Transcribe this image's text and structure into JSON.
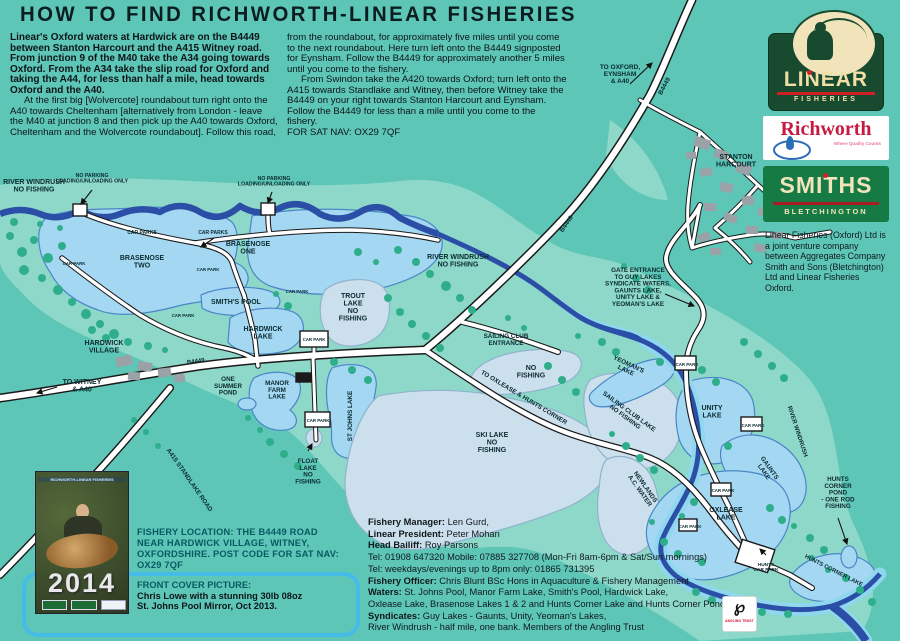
{
  "title": "HOW TO FIND RICHWORTH-LINEAR FISHERIES",
  "intro": {
    "col1_bold": "Linear's Oxford waters at Hardwick are on the B4449 between Stanton Harcourt and the A415 Witney road. From junction 9 of the M40 take the A34 going towards Oxford. From the A34 take the slip road for Oxford and taking the A44, for less than half a mile, head towards Oxford and the A40.",
    "col1_rest": "At the first big [Wolvercote] roundabout turn right onto the A40 towards Cheltenham [alternatively from London - leave the M40 at junction 8 and then pick up the A40 towards Oxford, Cheltenham and the Wolvercote roundabout]. Follow this road,",
    "col2_p1": "from the roundabout, for approximately five miles until you come to the next roundabout. Here turn left onto the B4449 signposted for Eynsham. Follow the B4449 for approximately another 5 miles until you come to the fishery.",
    "col2_p2": "From Swindon take the A420 towards Oxford; turn left onto the A415 towards Standlake and Witney, then before Witney take the B4449 on your right towards Stanton Harcourt and Eynsham. Follow the B4449 for less than a mile until you come to the fishery.",
    "col2_satnav": "FOR SAT NAV: OX29 7QF"
  },
  "logos": {
    "linear_name": "LINEAR",
    "linear_sub": "FISHERIES",
    "richworth_name": "Richworth",
    "richworth_tagline": "Where Quality Counts",
    "smiths_name": "SMITHS",
    "smiths_sub": "BLETCHINGTON",
    "joint_venture": "Linear Fisheries (Oxford) Ltd is a joint venture company between Aggregates Company Smith and Sons (Bletchington) Ltd and Linear Fisheries Oxford."
  },
  "location_box": {
    "location": "FISHERY LOCATION: THE B4449 ROAD NEAR HARDWICK VILLAGE, WITNEY, OXFORDSHIRE. POST CODE FOR SAT NAV: OX29 7QF",
    "front_cover_heading": "FRONT COVER PICTURE:",
    "front_cover_line1": "Chris Lowe with a stunning 30lb 08oz",
    "front_cover_line2": "St. Johns Pool Mirror, Oct 2013."
  },
  "cover": {
    "strip": "RICHWORTH-LINEAR FISHERIES",
    "year": "2014"
  },
  "angling": {
    "label": "ANGLING TRUST"
  },
  "contacts": {
    "lines": [
      {
        "label": "Fishery Manager:",
        "value": " Len Gurd,"
      },
      {
        "label": "Linear President:",
        "value": " Peter Mohan"
      },
      {
        "label": "Head Bailiff:",
        "value": " Roy Parsons"
      },
      {
        "label": "",
        "value": "Tel: 01908 647320 Mobile: 07885 327708 (Mon-Fri 8am-6pm & Sat/Sun mornings)"
      },
      {
        "label": "",
        "value": "Tel: weekdays/evenings up to 8pm only: 01865 731395"
      },
      {
        "label": "Fishery Officer:",
        "value": " Chris Blunt BSc Hons in Aquaculture & Fishery Management"
      },
      {
        "label": "Waters:",
        "value": " St. Johns Pool, Manor Farm Lake, Smith's Pool, Hardwick Lake,"
      },
      {
        "label": "",
        "value": "Oxlease Lake, Brasenose Lakes 1 & 2 and Hunts Corner Lake and Hunts Corner Pond."
      },
      {
        "label": "Syndicates:",
        "value": " Guy Lakes - Gaunts, Unity, Yeoman's Lakes,"
      },
      {
        "label": "",
        "value": "River Windrush - half mile, one bank. Members of the Angling Trust"
      }
    ]
  },
  "map_labels": [
    {
      "t": "RIVER WINDRUSH\nNO FISHING",
      "x": 34,
      "y": 184,
      "s": 7
    },
    {
      "t": "NO PARKING\nLOADING/UNLOADING ONLY",
      "x": 92,
      "y": 177,
      "s": 5.2
    },
    {
      "t": "NO PARKING\nLOADING/UNLOADING ONLY",
      "x": 274,
      "y": 180,
      "s": 5.2
    },
    {
      "t": "CAR PARKS",
      "x": 142,
      "y": 234,
      "s": 5
    },
    {
      "t": "CAR PARKS",
      "x": 213,
      "y": 234,
      "s": 5
    },
    {
      "t": "BRASENOSE\nTWO",
      "x": 142,
      "y": 260,
      "s": 7
    },
    {
      "t": "BRASENOSE\nONE",
      "x": 248,
      "y": 246,
      "s": 7
    },
    {
      "t": "RIVER WINDRUSH\nNO FISHING",
      "x": 458,
      "y": 259,
      "s": 7
    },
    {
      "t": "SMITH'S POOL",
      "x": 236,
      "y": 304,
      "s": 7
    },
    {
      "t": "HARDWICK\nLAKE",
      "x": 263,
      "y": 331,
      "s": 7
    },
    {
      "t": "TROUT\nLAKE\nNO\nFISHING",
      "x": 353,
      "y": 298,
      "s": 7
    },
    {
      "t": "HARDWICK\nVILLAGE",
      "x": 104,
      "y": 345,
      "s": 7
    },
    {
      "t": "TO WITNEY\n& A40",
      "x": 82,
      "y": 384,
      "s": 7
    },
    {
      "t": "B4449",
      "x": 196,
      "y": 363,
      "s": 6,
      "r": -8
    },
    {
      "t": "ONE\nSUMMER\nPOND",
      "x": 228,
      "y": 381,
      "s": 6.3
    },
    {
      "t": "MANOR\nFARM\nLAKE",
      "x": 277,
      "y": 385,
      "s": 6.3
    },
    {
      "t": "ST JOHNS LAKE",
      "x": 352,
      "y": 416,
      "s": 6.3,
      "r": -90
    },
    {
      "t": "FLOAT\nLAKE\nNO\nFISHING",
      "x": 308,
      "y": 463,
      "s": 6.3
    },
    {
      "t": "A415 STANDLAKE ROAD",
      "x": 188,
      "y": 481,
      "s": 6.3,
      "r": 55
    },
    {
      "t": "B4449",
      "x": 568,
      "y": 225,
      "s": 6.3,
      "r": -55
    },
    {
      "t": "B4449",
      "x": 666,
      "y": 87,
      "s": 6.3,
      "r": -62
    },
    {
      "t": "TO OXFORD,\nEYNSHAM\n& A40",
      "x": 620,
      "y": 69,
      "s": 6.5
    },
    {
      "t": "STANTON\nHARCOURT",
      "x": 736,
      "y": 159,
      "s": 7
    },
    {
      "t": "SAILING CLUB\nENTRANCE",
      "x": 506,
      "y": 338,
      "s": 6.3
    },
    {
      "t": "NO\nFISHING",
      "x": 531,
      "y": 370,
      "s": 7
    },
    {
      "t": "TO OXLEASE & HUNTS CORNER",
      "x": 523,
      "y": 399,
      "s": 6.3,
      "r": 31
    },
    {
      "t": "SKI LAKE\nNO\nFISHING",
      "x": 492,
      "y": 437,
      "s": 7
    },
    {
      "t": "SAILING CLUB LAKE\nNO FISHING",
      "x": 628,
      "y": 413,
      "s": 6.3,
      "r": 36
    },
    {
      "t": "GATE ENTRANCE\nTO GUY LAKES\nSYNDICATE WATERS,\nGAUNTS LAKE,\nUNITY LAKE &\nYEOMAN'S LAKE",
      "x": 638,
      "y": 272,
      "s": 6.3
    },
    {
      "t": "YEOMAN'S\nLAKE",
      "x": 628,
      "y": 366,
      "s": 6.3,
      "r": 25
    },
    {
      "t": "UNITY\nLAKE",
      "x": 712,
      "y": 410,
      "s": 7
    },
    {
      "t": "RIVER WINDRUSH",
      "x": 796,
      "y": 432,
      "s": 6,
      "r": 72
    },
    {
      "t": "NEWLANDS\nA.C. WATER",
      "x": 644,
      "y": 488,
      "s": 6.3,
      "r": 55
    },
    {
      "t": "GAUNTS\nLAKE",
      "x": 768,
      "y": 469,
      "s": 6.3,
      "r": 55
    },
    {
      "t": "OXLEASE\nLAKE",
      "x": 726,
      "y": 512,
      "s": 7
    },
    {
      "t": "HUNTS\nCORNER\nPOND\n- ONE ROD\nFISHING",
      "x": 838,
      "y": 481,
      "s": 6.3
    },
    {
      "t": "HUNTS CORNER LAKE",
      "x": 833,
      "y": 572,
      "s": 5.8,
      "r": 27
    },
    {
      "t": "HUNTS\nCAR PARK",
      "x": 766,
      "y": 566,
      "s": 4.8
    },
    {
      "t": "CAR PARK",
      "x": 74,
      "y": 265,
      "s": 4.4
    },
    {
      "t": "CAR PARK",
      "x": 208,
      "y": 271,
      "s": 4.4
    },
    {
      "t": "CAR PARK",
      "x": 183,
      "y": 317,
      "s": 4.4
    },
    {
      "t": "CAR PARK",
      "x": 297,
      "y": 293,
      "s": 4.4
    },
    {
      "t": "CAR PARK",
      "x": 314,
      "y": 341,
      "s": 4.4
    },
    {
      "t": "CAR PARK",
      "x": 318,
      "y": 422,
      "s": 4.4
    },
    {
      "t": "CAR PARK",
      "x": 687,
      "y": 366,
      "s": 4.4
    },
    {
      "t": "CAR PARK",
      "x": 753,
      "y": 427,
      "s": 4.4
    },
    {
      "t": "CAR PARK",
      "x": 723,
      "y": 492,
      "s": 4.4
    },
    {
      "t": "CAR PARK",
      "x": 690,
      "y": 528,
      "s": 4.4
    }
  ],
  "colors": {
    "background": "#5dc6b7",
    "floodplain": "#8ed8c9",
    "tree": "#2fae8b",
    "lake_open": "#a4d7f1",
    "lake_no_fishing": "#ccdfec",
    "river": "#2b4fa6",
    "river_bank": "#8fd7ee",
    "road_fill": "#ffffff",
    "road_edge": "#1a1a1a",
    "building": "#9aa2a8",
    "label_text": "#0a2a30",
    "accent_red": "#cf2027",
    "linear_green": "#174a2f",
    "smiths_green": "#157a43",
    "richworth_red": "#c61a41",
    "box_border": "#45bce8",
    "heading_teal": "#085a62"
  }
}
